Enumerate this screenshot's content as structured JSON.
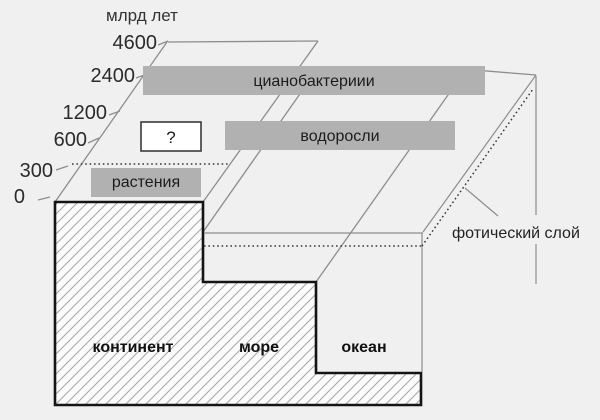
{
  "diagram": {
    "axis": {
      "title": "млрд лет",
      "ticks": [
        "4600",
        "2400",
        "1200",
        "600",
        "300",
        "0"
      ]
    },
    "bars": {
      "cyanobacteria": "цианобактериии",
      "algae": "водоросли",
      "plants": "растения",
      "unknown": "?"
    },
    "zones": {
      "continent": "континент",
      "sea": "море",
      "ocean": "океан"
    },
    "photic_layer": "фотический слой",
    "colors": {
      "background": "#f0f0f0",
      "bar_fill": "#b1b1b1",
      "outline": "#141414",
      "thin_line": "#8d8d8d",
      "hatch_line": "#a9a9a9",
      "hatch_bg": "#fcfcfc",
      "dotted_line": "#3a3a3a"
    }
  }
}
